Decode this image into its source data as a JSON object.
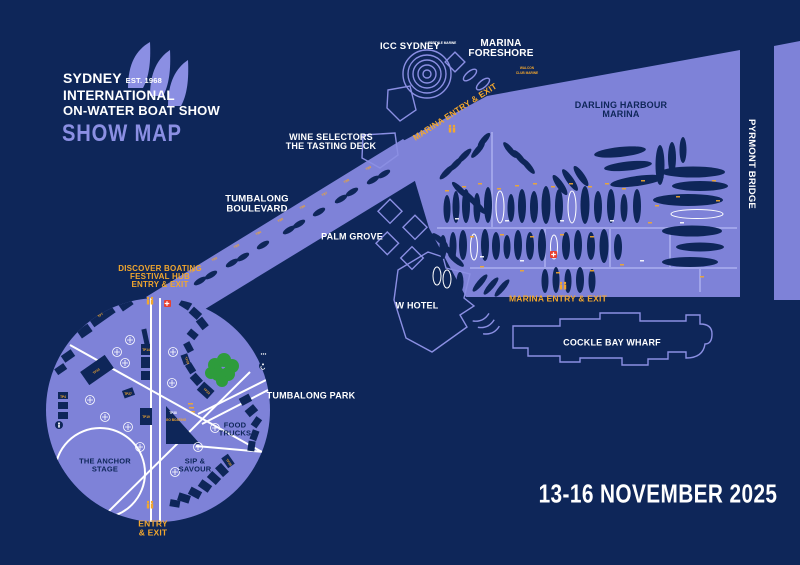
{
  "logo": {
    "name": "SYDNEY",
    "est": "EST. 1968",
    "line2": "INTERNATIONAL",
    "line3": "ON-WATER BOAT SHOW",
    "map_title": "SHOW MAP"
  },
  "event": {
    "dates": "13-16 NOVEMBER 2025"
  },
  "venues": {
    "icc": "ICC SYDNEY",
    "foreshore_l1": "MARINA",
    "foreshore_l2": "FORESHORE",
    "darling_l1": "DARLING HARBOUR",
    "darling_l2": "MARINA",
    "pyrmont": "PYRMONT BRIDGE",
    "wine_l1": "WINE SELECTORS",
    "wine_l2": "THE TASTING DECK",
    "blvd_l1": "TUMBALONG",
    "blvd_l2": "BOULEVARD",
    "palm": "PALM GROVE",
    "whotel": "W HOTEL",
    "cockle": "COCKLE BAY WHARF",
    "park": "TUMBALONG PARK",
    "anchor_l1": "THE ANCHOR",
    "anchor_l2": "STAGE",
    "food_l1": "FOOD",
    "food_l2": "TRUCKS",
    "sip_l1": "SIP &",
    "sip_l2": "SAVOUR"
  },
  "gates": {
    "marina_top": "MARINA ENTRY & EXIT",
    "marina_bottom": "MARINA ENTRY & EXIT",
    "discover_l1": "DISCOVER BOATING",
    "discover_l2": "FESTIVAL HUB",
    "discover_l3": "ENTRY & EXIT",
    "south_l1": "ENTRY",
    "south_l2": "& EXIT"
  },
  "exhibitors": {
    "walcon": "WALCON",
    "club_marine": "CLUB MARINE",
    "lifestyle": "LIFESTYLE MARINE",
    "go_boating": "GO BOATING",
    "tb_labels": [
      "TB1",
      "TB2",
      "TB3",
      "TB4",
      "TB5",
      "TB6",
      "TB7",
      "TB8",
      "TB9"
    ],
    "tp_labels": [
      "TP4",
      "TP7",
      "TP10",
      "TP14",
      "TP19",
      "TP23",
      "TP27",
      "TP30",
      "TP33",
      "TP38"
    ]
  },
  "colors": {
    "background": "#0E2659",
    "land": "#7E82D8",
    "accent": "#8B8FE3",
    "highlight": "#F2A72E",
    "alert": "#E8402F",
    "tree": "#2E9C3C",
    "white": "#FFFFFF"
  }
}
